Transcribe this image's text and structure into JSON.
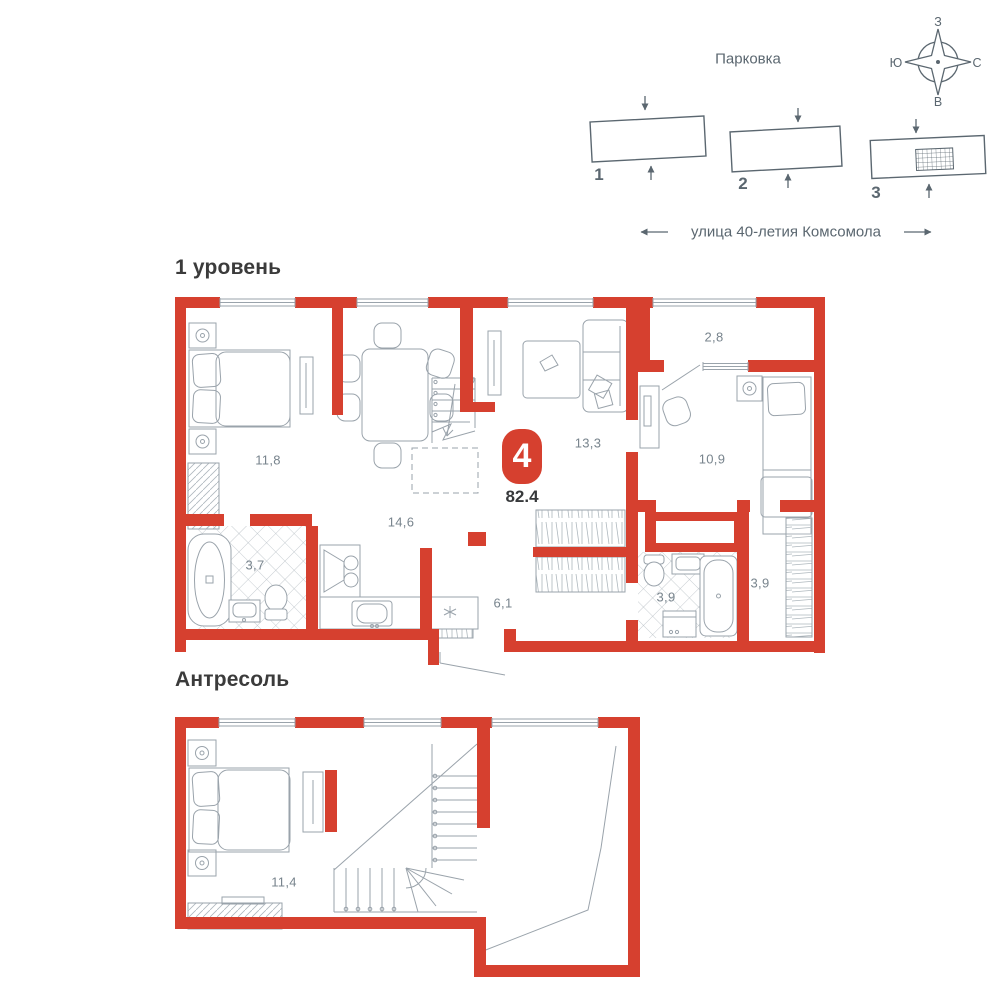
{
  "site_plan": {
    "parking_label": "Парковка",
    "street_label": "улица 40-летия Комсомола",
    "buildings": [
      {
        "number": "1"
      },
      {
        "number": "2"
      },
      {
        "number": "3"
      }
    ],
    "compass": {
      "top": "З",
      "left": "Ю",
      "right": "С",
      "bottom": "В"
    }
  },
  "apartment": {
    "rooms_count": "4",
    "total_area": "82.4"
  },
  "levels": [
    {
      "title": "1 уровень",
      "rooms": [
        {
          "name": "bedroom",
          "area": "11,8"
        },
        {
          "name": "kitchen-dining",
          "area": "14,6"
        },
        {
          "name": "living-room",
          "area": "13,3"
        },
        {
          "name": "loggia",
          "area": "2,8"
        },
        {
          "name": "bedroom-2",
          "area": "10,9"
        },
        {
          "name": "bathroom",
          "area": "3,7"
        },
        {
          "name": "hallway",
          "area": "6,1"
        },
        {
          "name": "bathroom-2",
          "area": "3,9"
        },
        {
          "name": "wardrobe-room",
          "area": "3,9"
        }
      ]
    },
    {
      "title": "Антресоль",
      "rooms": [
        {
          "name": "bedroom-mezzanine",
          "area": "11,4"
        }
      ]
    }
  ],
  "colors": {
    "wall": "#d6402f",
    "furniture_line": "#9aa3ab",
    "site_line": "#5b6770",
    "label_text": "#78848d"
  }
}
